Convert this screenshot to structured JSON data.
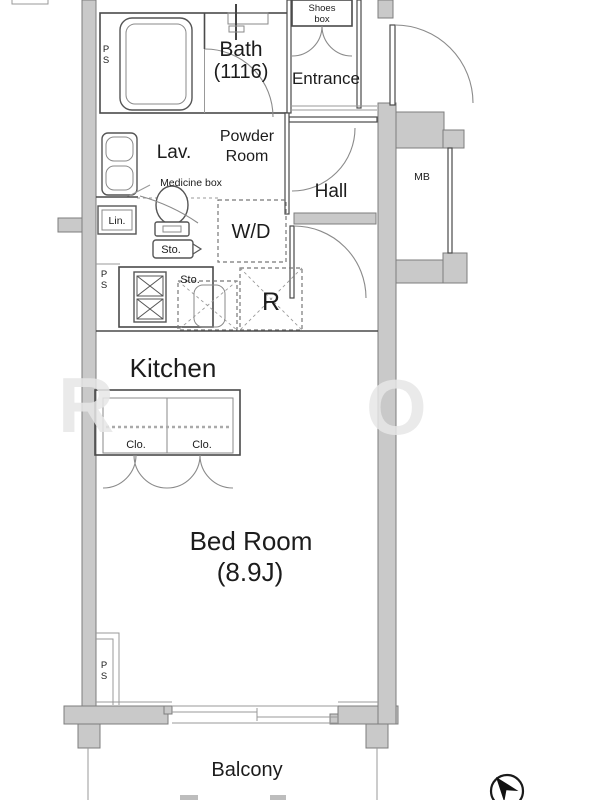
{
  "plan": {
    "rooms": {
      "bath": {
        "name": "Bath",
        "size": "(1116)"
      },
      "entrance": {
        "name": "Entrance"
      },
      "shoes_box": {
        "line1": "Shoes",
        "line2": "box"
      },
      "powder_room": {
        "line1": "Powder",
        "line2": "Room"
      },
      "lav": {
        "name": "Lav."
      },
      "medicine_box": {
        "name": "Medicine box"
      },
      "hall": {
        "name": "Hall"
      },
      "kitchen": {
        "name": "Kitchen"
      },
      "bedroom": {
        "name": "Bed Room",
        "size": "(8.9J)"
      },
      "balcony": {
        "name": "Balcony"
      }
    },
    "fixtures": {
      "mb": "MB",
      "lin": "Lin.",
      "sto_powder": "Sto.",
      "sto_kitchen": "Sto.",
      "wd": "W/D",
      "refrigerator": "R",
      "closet_left": "Clo.",
      "closet_right": "Clo.",
      "ps_top": {
        "line1": "P",
        "line2": "S"
      },
      "ps_mid": {
        "line1": "P",
        "line2": "S"
      },
      "ps_bottom": {
        "line1": "P",
        "line2": "S"
      }
    },
    "watermark": {
      "left": "R",
      "right": "O"
    },
    "icons": {
      "compass": "compass-north-icon"
    },
    "colors": {
      "wall": "#c9c9c9",
      "wall_outline": "#7d7d7d",
      "line": "#4a4a4a",
      "text": "#1c1c1c"
    }
  }
}
